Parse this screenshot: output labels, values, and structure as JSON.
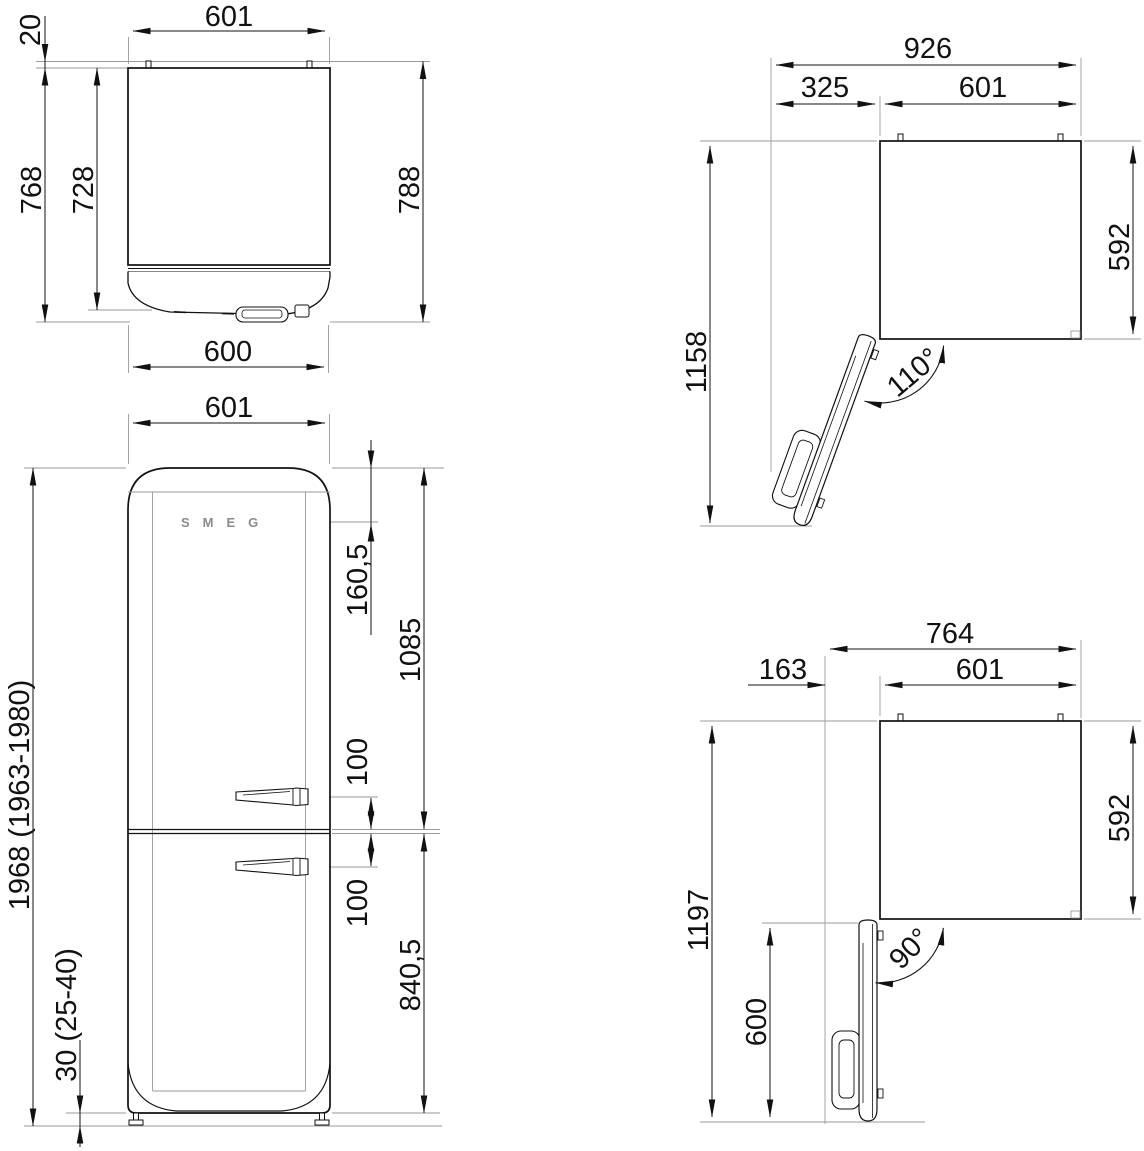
{
  "document": {
    "type": "refrigerator installation technical drawing"
  },
  "brand": {
    "logo": "SMEG"
  },
  "views": {
    "top": {
      "dims": {
        "width": "601",
        "hinge_pin_offset": "20",
        "depth_body": "728",
        "depth_with_door": "768",
        "depth_total": "788",
        "door_width": "600"
      }
    },
    "front": {
      "dims": {
        "width": "601",
        "logo_from_top": "160,5",
        "top_section_height": "1085",
        "upper_handle_to_split": "100",
        "split_to_lower_handle": "100",
        "bottom_section_height": "840,5",
        "overall_height": "1968 (1963-1980)",
        "feet_height": "30 (25-40)"
      }
    },
    "plan_open_110": {
      "angle": "110°",
      "dims": {
        "overall_width": "926",
        "door_swing": "325",
        "width": "601",
        "overall_depth": "1158",
        "body_depth": "592"
      }
    },
    "plan_open_90": {
      "angle": "90°",
      "dims": {
        "overall_width": "764",
        "door_clearance": "163",
        "width": "601",
        "overall_depth": "1197",
        "body_depth": "592",
        "door_depth": "600"
      }
    }
  }
}
